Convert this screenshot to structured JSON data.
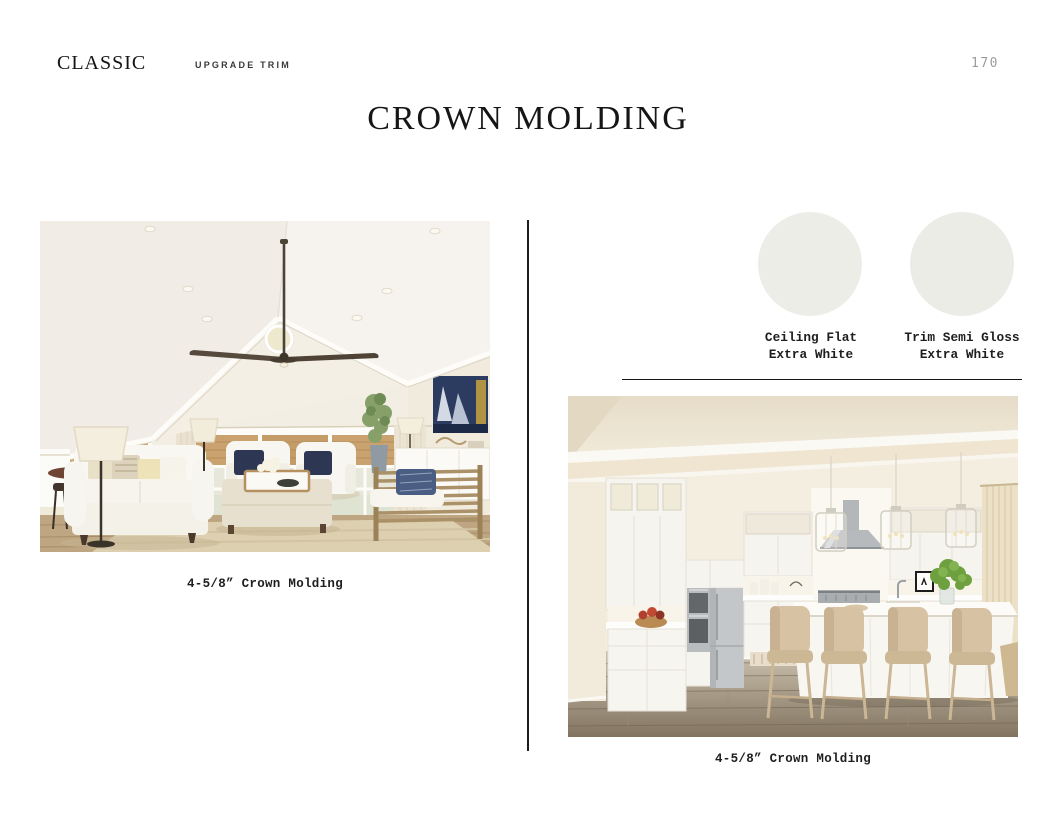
{
  "header": {
    "collection": "CLASSIC",
    "section": "UPGRADE TRIM",
    "page_number": "170",
    "title": "CROWN MOLDING"
  },
  "figures": {
    "living_room": {
      "caption": "4-5/8” Crown Molding",
      "alt": "Living room rendering with vaulted ceiling, ceiling fan and crown molding"
    },
    "kitchen": {
      "caption": "4-5/8” Crown Molding",
      "alt": "White kitchen rendering with island, stools and crown molding"
    }
  },
  "swatches": {
    "items": [
      {
        "line1": "Ceiling Flat",
        "line2": "Extra White",
        "color": "#EDEDE8"
      },
      {
        "line1": "Trim Semi Gloss",
        "line2": "Extra White",
        "color": "#ECECE7"
      }
    ]
  },
  "colors": {
    "page_background": "#FFFFFF",
    "rule": "#1C1C1C",
    "page_number_gray": "#9C9C9C"
  }
}
